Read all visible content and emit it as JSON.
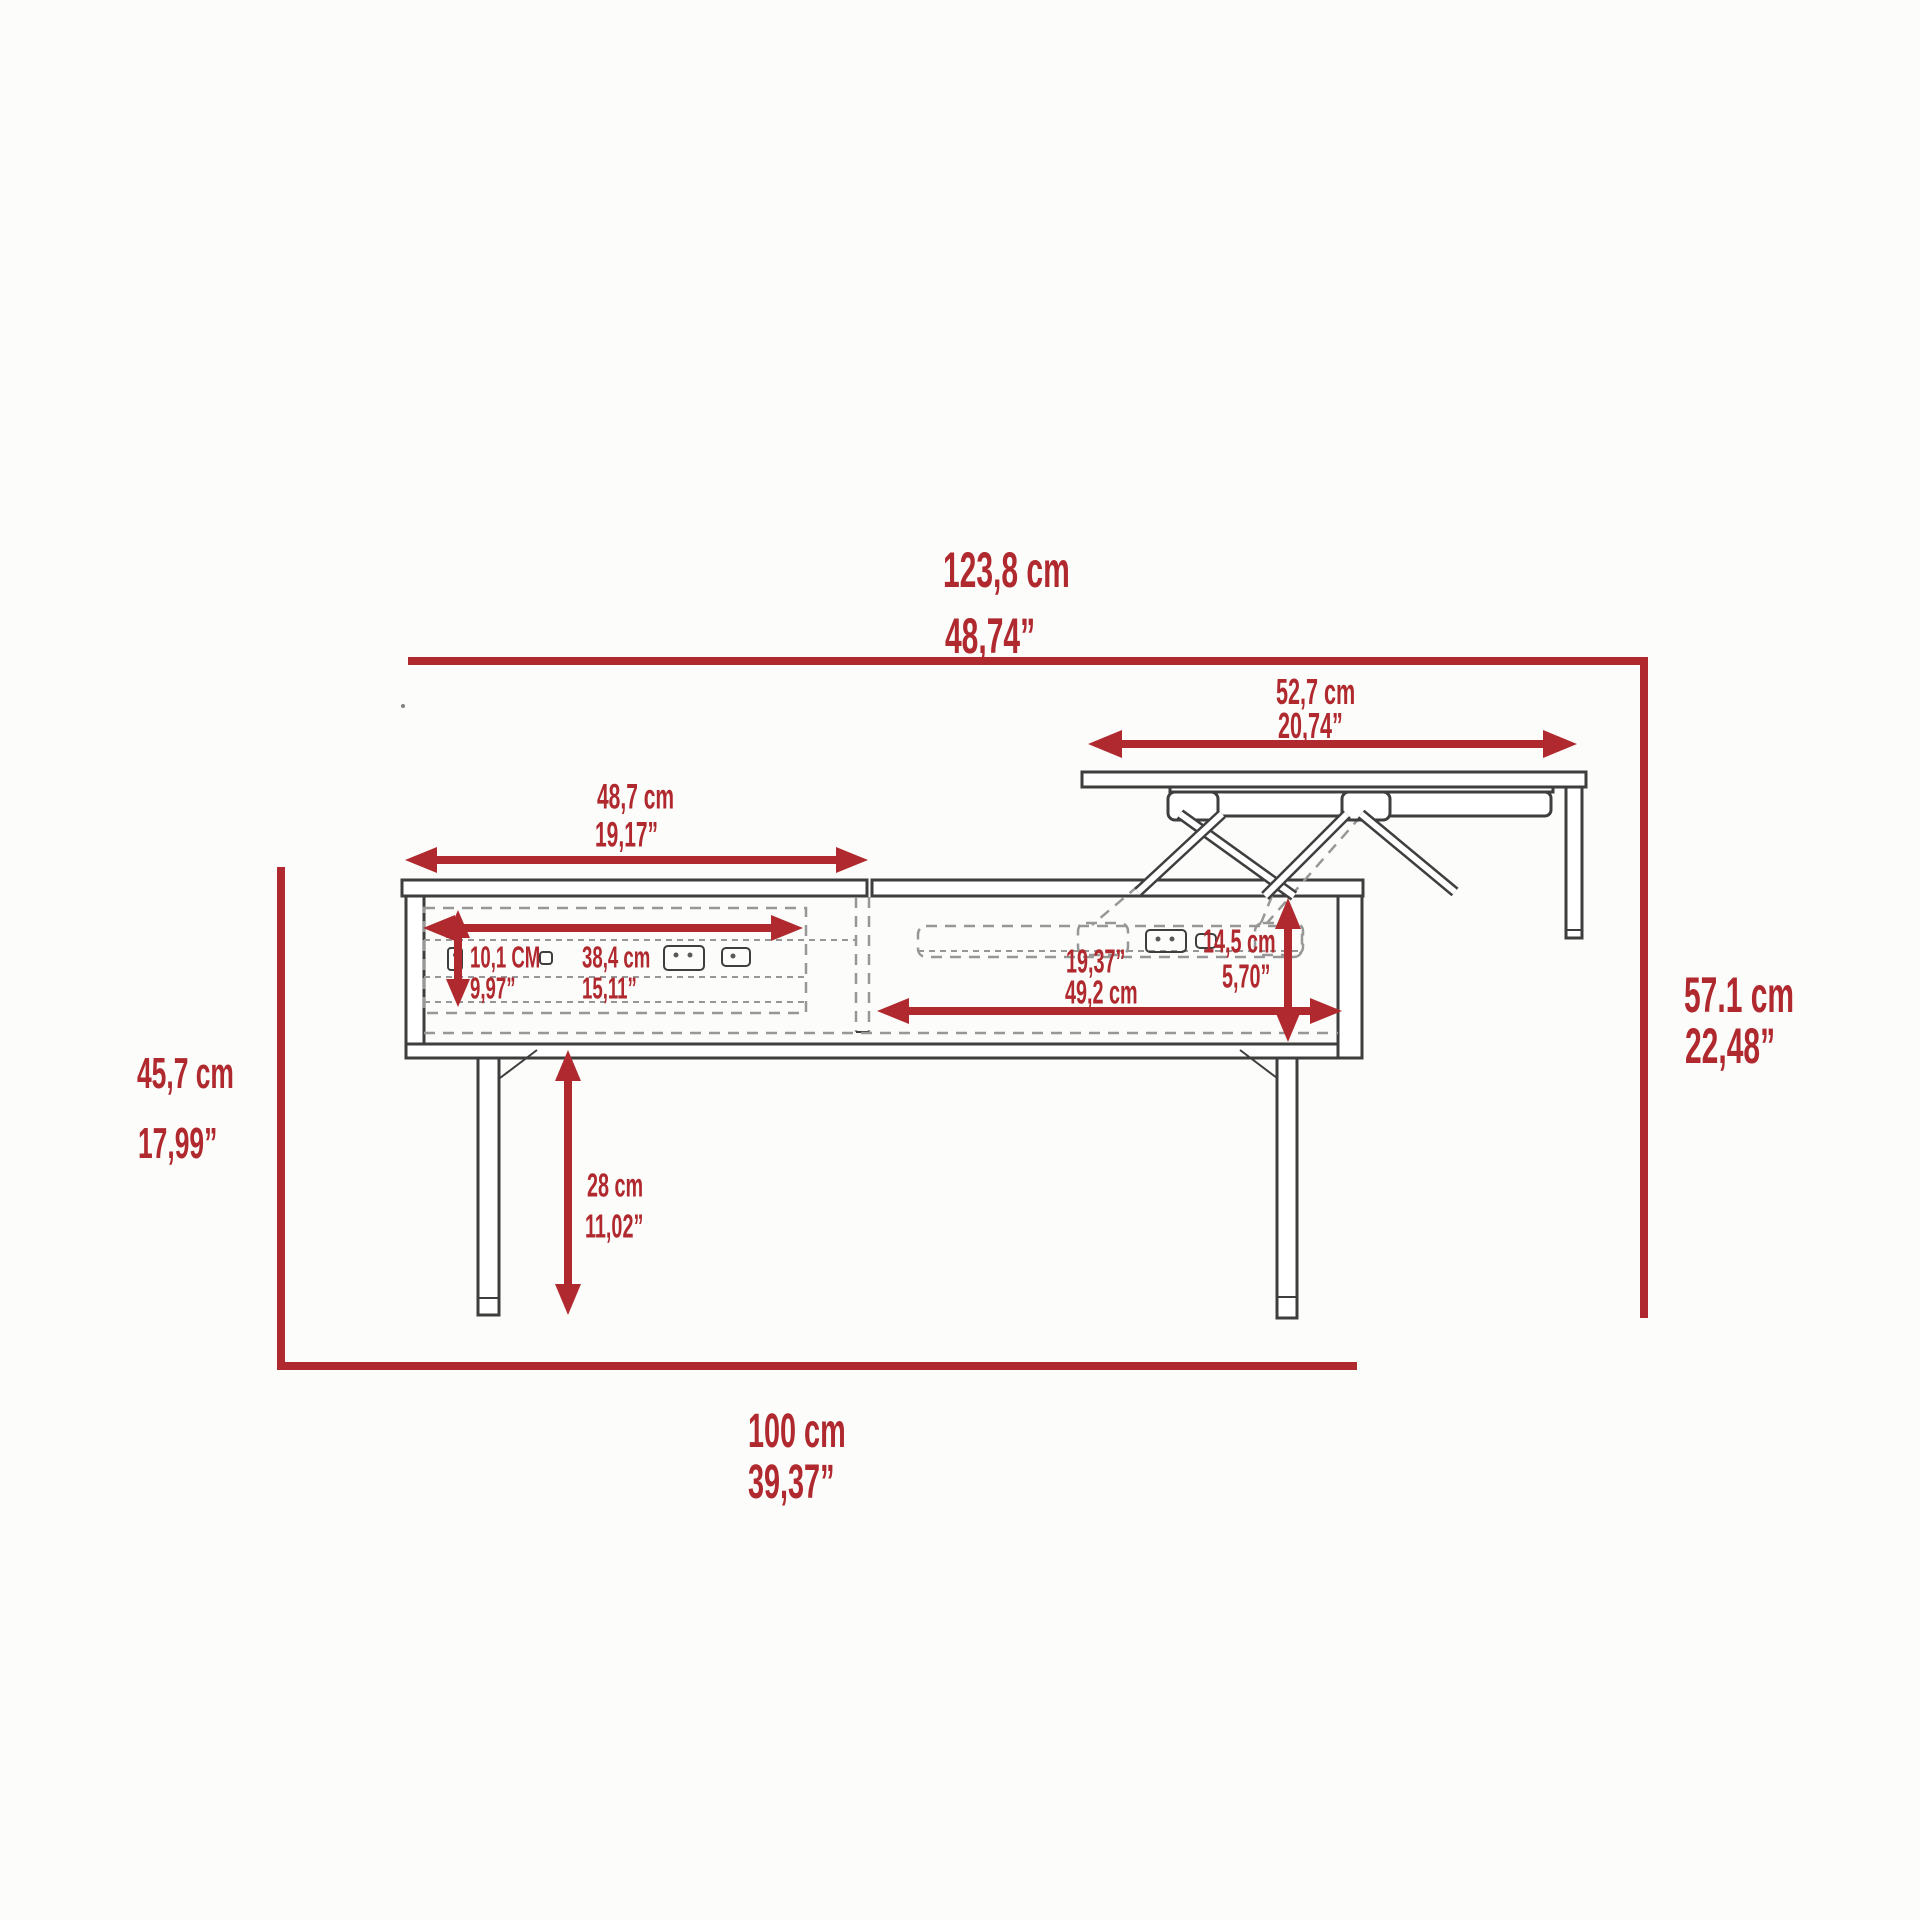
{
  "page": {
    "background": "#FCFCFA"
  },
  "diagram": {
    "description": "Lift-top coffee table dimension drawing, side view",
    "accent_color": "#B0292E",
    "line_color": "#3E3E3E",
    "dash_color": "#979797",
    "dims": {
      "overall_width": {
        "cm": "123,8 cm",
        "inch": "48,74”"
      },
      "lift_top_width": {
        "cm": "52,7 cm",
        "inch": "20,74”"
      },
      "left_top_width": {
        "cm": "48,7 cm",
        "inch": "19,17”"
      },
      "drawer_height": {
        "cm": "10,1 CM",
        "inch": "9,97”"
      },
      "drawer_width": {
        "cm": "38,4 cm",
        "inch": "15,11”"
      },
      "right_compartment_width": {
        "inch": "19,37”",
        "cm": "49,2 cm"
      },
      "lift_rise": {
        "cm": "14,5 cm",
        "inch": "5,70”"
      },
      "table_height": {
        "cm": "45,7 cm",
        "inch": "17,99”"
      },
      "lifted_top_height": {
        "cm": "57.1 cm",
        "inch": "22,48”"
      },
      "leg_height": {
        "cm": "28 cm",
        "inch": "11,02”"
      },
      "table_depth": {
        "cm": "100 cm",
        "inch": "39,37”"
      }
    }
  }
}
